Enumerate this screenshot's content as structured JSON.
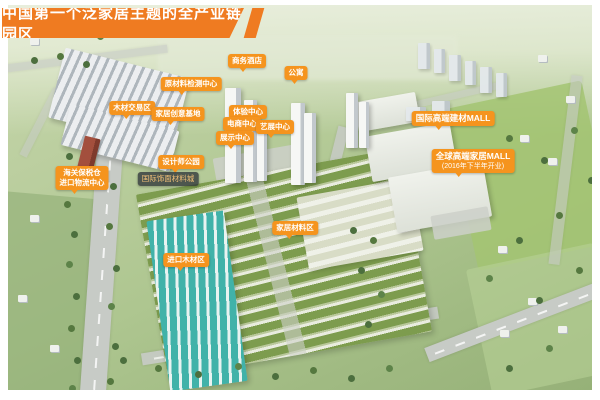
{
  "banner": {
    "title": "中国第一个泛家居主题的全产业链园区"
  },
  "colors": {
    "banner_orange": "#ef7b21",
    "label_orange": "#f5941e",
    "roof_green": "#7d9c4e",
    "teal_roof": "#41b2a9"
  },
  "labels": {
    "hotel": {
      "text": "商务酒店"
    },
    "apartment": {
      "text": "公寓"
    },
    "material_testing": {
      "text": "原材料检测中心"
    },
    "timber_trade": {
      "text": "木材交易区"
    },
    "creative_base": {
      "text": "家居创意基地"
    },
    "experience_center": {
      "text": "体验中心"
    },
    "ecommerce_center": {
      "text": "电商中心"
    },
    "art_exhibition": {
      "text": "艺展中心"
    },
    "exhibition_center": {
      "text": "展示中心"
    },
    "designer_park": {
      "text": "设计师公园"
    },
    "veneer_city": {
      "text": "国际饰面材料城"
    },
    "bonded_warehouse": {
      "line1": "海关保税仓",
      "line2": "进口物流中心"
    },
    "home_materials": {
      "text": "家居材料区"
    },
    "imported_timber": {
      "text": "进口木材区"
    },
    "intl_mall": {
      "text": "国际高端建材MALL"
    },
    "global_mall": {
      "line1": "全球高端家居MALL",
      "line2": "(2016年下半年开业)"
    }
  }
}
